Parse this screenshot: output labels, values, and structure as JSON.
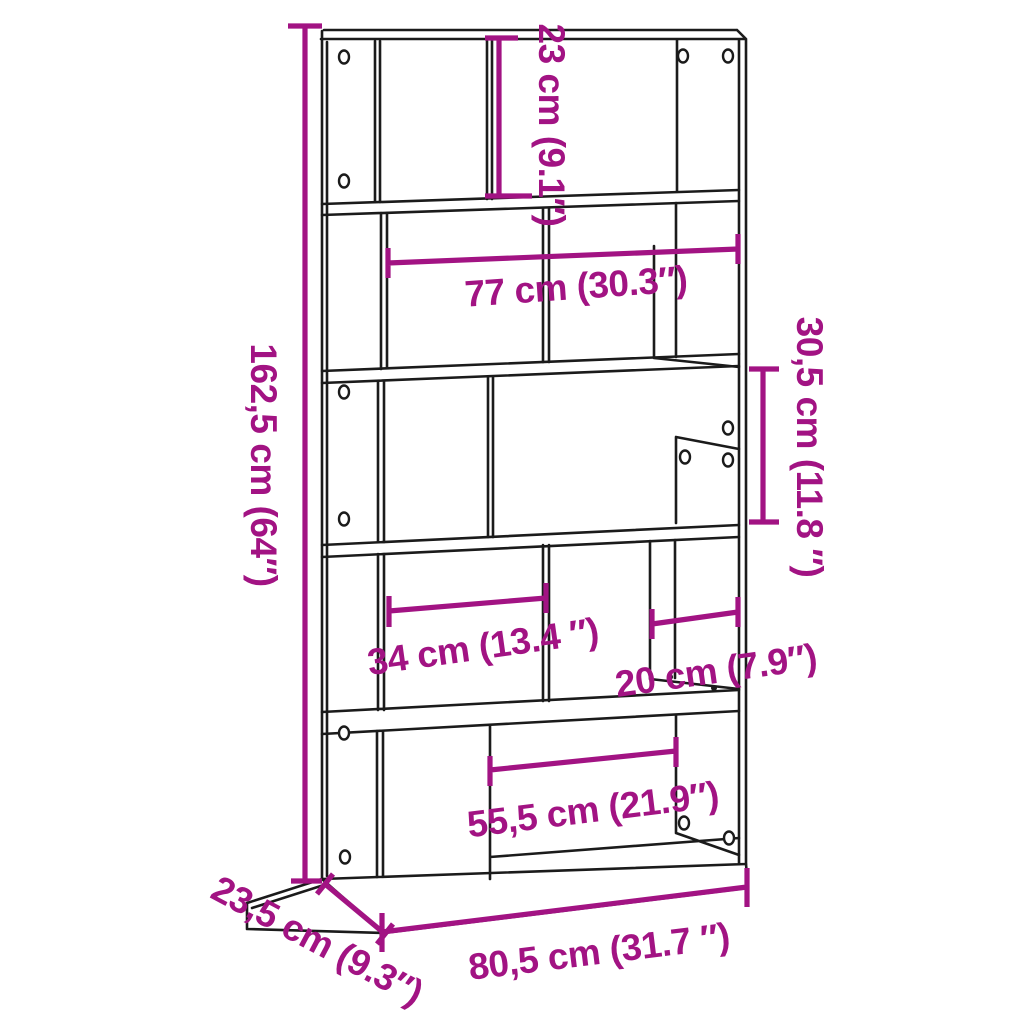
{
  "colors": {
    "accent": "#A21383",
    "line": "#1B1B1B",
    "background": "#FFFFFF"
  },
  "diagram": {
    "subject": "5-tier bookcase line drawing with dimension annotations",
    "dimensions": {
      "total_height": {
        "text": "162,5 cm (64″)",
        "cm": "162,5",
        "inches": "64"
      },
      "top_compartment_height": {
        "text": "23 cm (9.1″)",
        "cm": "23",
        "inches": "9.1"
      },
      "inner_width": {
        "text": "77 cm (30.3″)",
        "cm": "77",
        "inches": "30.3"
      },
      "side_compartment_height": {
        "text": "30,5 cm (11.8 ″)",
        "cm": "30,5",
        "inches": "11.8"
      },
      "left_compartment_width": {
        "text": "34 cm (13.4 ″)",
        "cm": "34",
        "inches": "13.4"
      },
      "right_compartment_width": {
        "text": "20 cm (7.9″)",
        "cm": "20",
        "inches": "7.9"
      },
      "bottom_compartment_width": {
        "text": "55,5 cm (21.9″)",
        "cm": "55,5",
        "inches": "21.9"
      },
      "total_width": {
        "text": "80,5 cm (31.7 ″)",
        "cm": "80,5",
        "inches": "31.7"
      },
      "depth": {
        "text": "23,5 cm (9.3″)",
        "cm": "23,5",
        "inches": "9.3"
      }
    }
  }
}
